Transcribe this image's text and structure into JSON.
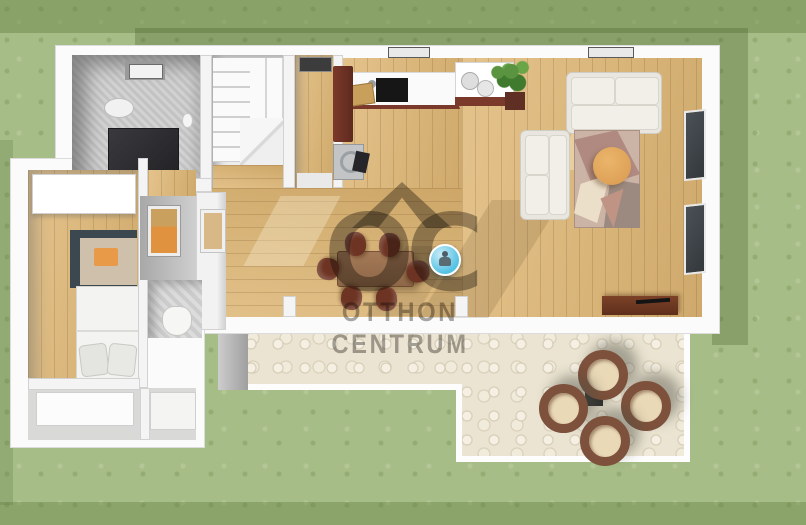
{
  "scene": {
    "kind": "3d-floor-plan-rendering",
    "rooms": [
      "bathroom",
      "staircase",
      "closet",
      "kitchen",
      "living-room",
      "dining-area",
      "hallway",
      "bedroom",
      "wc",
      "entry",
      "terrace",
      "garden"
    ]
  },
  "watermark": {
    "logo": "OC",
    "line1": "OTTHON",
    "line2": "CENTRUM"
  },
  "marker": {
    "type": "panorama-viewpoint",
    "accent_color": "#54c2e4"
  },
  "colors": {
    "grass": "#a7bd88",
    "grass_shadow": "#46551f",
    "walls": "#fbfbfb",
    "wood_floor": "#dcb97e",
    "terrace_stone": "#ebe4d2",
    "kitchen_cabinet": "#6f3226",
    "dining_set": "#6d3423",
    "sofa": "#e9e6df",
    "coffee_table": "#e2a85f",
    "rug_base": "#cbb3a6",
    "rattan_chair": "#7d513b",
    "shower": "#2c2c2f",
    "bed_bench": "#3c4850",
    "accent_orange": "#e0923f"
  }
}
